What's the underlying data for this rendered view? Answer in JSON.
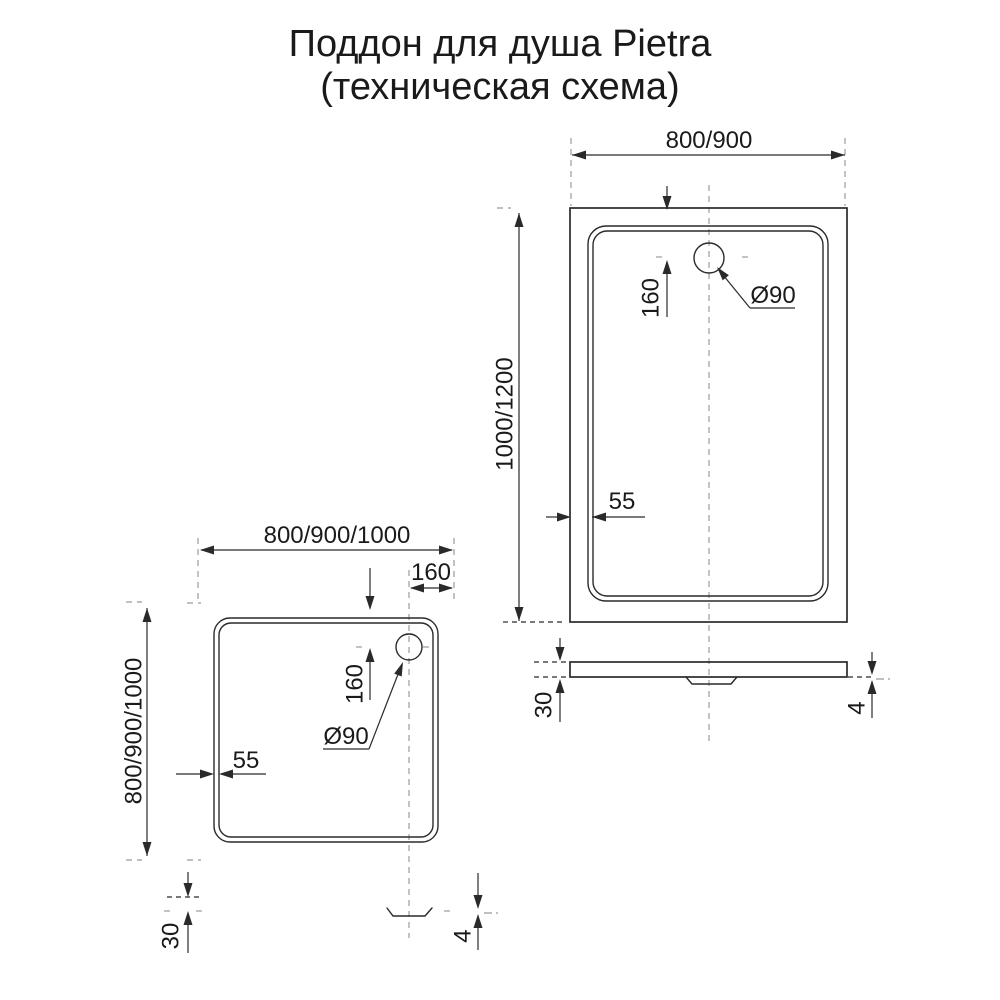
{
  "title": {
    "line1": "Поддон для душа Pietra",
    "line2": "(техническая схема)"
  },
  "top_view_rectangular": {
    "width": "800/900",
    "depth": "1000/1200",
    "drain_offset": "160",
    "drain_diameter": "Ø90",
    "wall_thickness": "55"
  },
  "side_view_rectangular": {
    "tray_height": "30",
    "drain_protrusion": "4"
  },
  "top_view_square": {
    "width": "800/900/1000",
    "depth": "800/900/1000",
    "drain_offset_vertical": "160",
    "drain_offset_horizontal": "160",
    "drain_diameter": "Ø90",
    "wall_thickness": "55"
  },
  "side_view_square": {
    "tray_height": "30",
    "drain_protrusion": "4"
  },
  "colors": {
    "line": "#2a2a2a",
    "dashed": "#9b9b9b",
    "background": "#ffffff",
    "text": "#1a1a1a"
  }
}
